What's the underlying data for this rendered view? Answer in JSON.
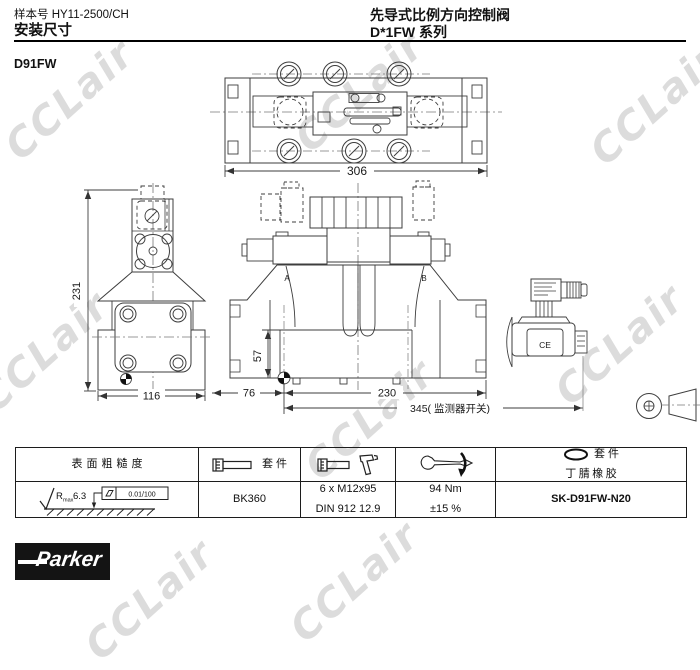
{
  "page": {
    "doc_number": "样本号 HY11-2500/CH",
    "section_title": "安装尺寸",
    "product_title": "先导式比例方向控制阀",
    "series_title": "D*1FW 系列",
    "model": "D91FW",
    "watermark_text": "CCLair"
  },
  "drawing": {
    "dim_306": "306",
    "dim_231": "231",
    "dim_116": "116",
    "dim_57": "57",
    "dim_76": "76",
    "dim_230": "230",
    "dim_345": "345( 监测器开关)",
    "port_a": "A",
    "port_b": "B",
    "ce_mark": "CE"
  },
  "table": {
    "col1_header": "表面粗糙度",
    "col2_header": "套 件",
    "col5_header_line1": "套 件",
    "col5_header_line2": "丁腈橡胶",
    "roughness_r": "R",
    "roughness_sub": "max",
    "roughness_value": "6.3",
    "flatness_tol": "0.01/100",
    "bolt_kit": "BK360",
    "bolt_spec1": "6 x M12x95",
    "bolt_spec2": "DIN 912 12.9",
    "torque1": "94 Nm",
    "torque2": "±15  %",
    "seal_kit": "SK-D91FW-N20"
  },
  "footer": {
    "brand": "Parker"
  }
}
